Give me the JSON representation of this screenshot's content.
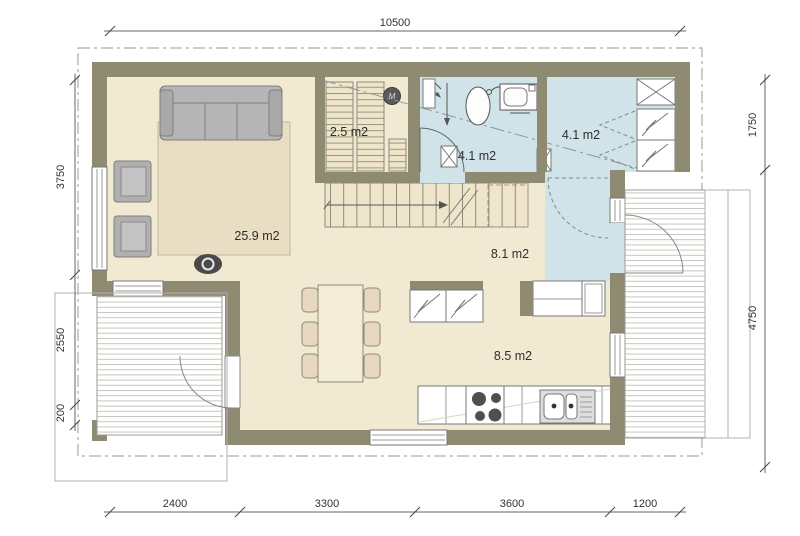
{
  "plan": {
    "rooms": [
      {
        "name": "living-room",
        "area_label": "25.9 m2"
      },
      {
        "name": "storage",
        "area_label": "2.5 m2"
      },
      {
        "name": "bathroom",
        "area_label": "4.1 m2"
      },
      {
        "name": "entry",
        "area_label": "4.1 m2"
      },
      {
        "name": "hall",
        "area_label": "8.1 m2"
      },
      {
        "name": "kitchen-dining",
        "area_label": "8.5 m2"
      }
    ],
    "dimensions": {
      "top": [
        "10500"
      ],
      "bottom": [
        "2400",
        "3300",
        "3600",
        "1200"
      ],
      "left": [
        "3750",
        "2550",
        "200"
      ],
      "right": [
        "1750",
        "4750"
      ]
    },
    "symbols": {
      "utility_marker": "M"
    },
    "colors": {
      "wall": "#8f8b73",
      "floor": "#f2e9d3",
      "wet_room": "#cfe3e8",
      "rug": "#e9dec3",
      "stair_wood": "#efe5cb",
      "furniture_gray": "#b5b5b5",
      "chair_tan": "#e7d8bf",
      "line": "#777777"
    }
  }
}
